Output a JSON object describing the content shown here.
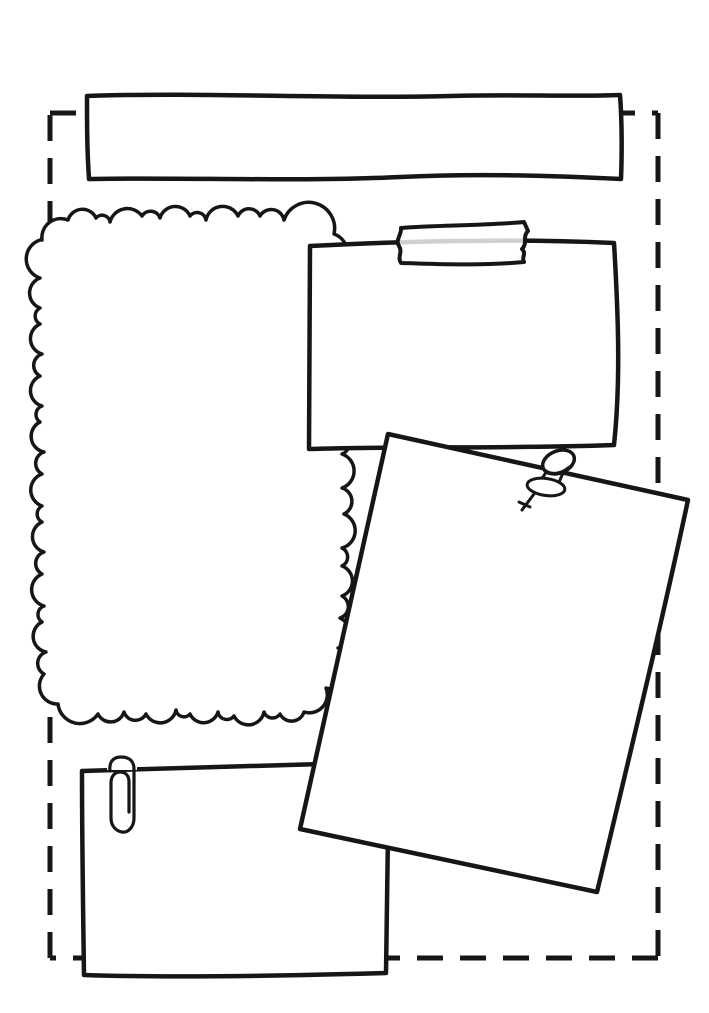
{
  "canvas": {
    "width": 709,
    "height": 1013,
    "background": "#ffffff"
  },
  "palette": {
    "ink": "#161616",
    "paper": "#ffffff",
    "tape_seam_gray": "#d1d1d1"
  },
  "elements": {
    "border": {
      "name": "dashed-cut-border",
      "style": "dashed cut line"
    },
    "banner": {
      "name": "title-banner-box",
      "content": ""
    },
    "frame": {
      "name": "scalloped-cloud-frame",
      "content": ""
    },
    "taped_note": {
      "name": "taped-note",
      "content": "",
      "attachment_icon": "washi-tape-icon"
    },
    "pinned_note": {
      "name": "pinned-note",
      "content": "",
      "attachment_icon": "pushpin-icon"
    },
    "clipped_note": {
      "name": "clipped-note",
      "content": "",
      "attachment_icon": "paperclip-icon"
    }
  }
}
